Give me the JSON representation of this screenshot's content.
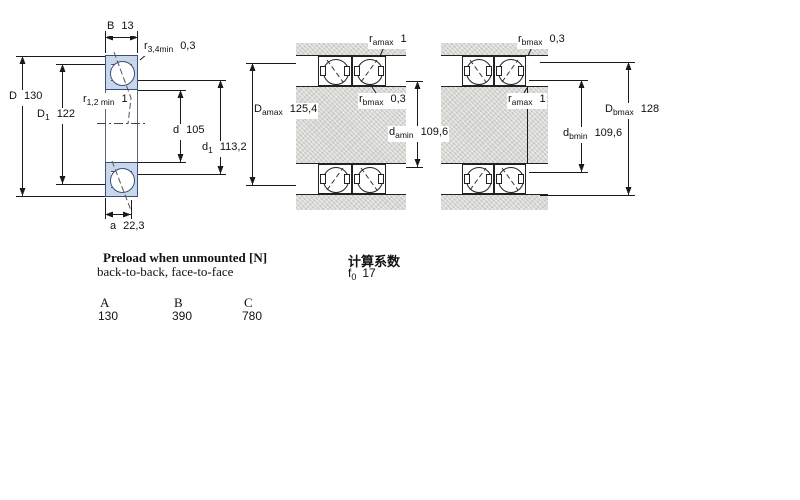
{
  "drawing": {
    "type": "bearing-dimension-drawing",
    "views": [
      "single-bearing-cross-section",
      "paired-mounting-a",
      "paired-mounting-b"
    ]
  },
  "colors": {
    "bearing_fill": "#c9d7ea",
    "bearing_outline": "#3d4e7c",
    "housing_grey": "#d7d7d3",
    "line": "#1a1a1a"
  },
  "dims": {
    "B": {
      "sym": "B",
      "sub": "",
      "value": "13"
    },
    "r34": {
      "sym": "r",
      "sub": "3,4min",
      "value": "0,3"
    },
    "D": {
      "sym": "D",
      "sub": "",
      "value": "130"
    },
    "D1": {
      "sym": "D",
      "sub": "1",
      "value": "122"
    },
    "r12": {
      "sym": "r",
      "sub": "1,2 min",
      "value": "1"
    },
    "d": {
      "sym": "d",
      "sub": "",
      "value": "105"
    },
    "d1": {
      "sym": "d",
      "sub": "1",
      "value": "113,2"
    },
    "a": {
      "sym": "a",
      "sub": "",
      "value": "22,3"
    },
    "ramax_a": {
      "sym": "r",
      "sub": "amax",
      "value": "1"
    },
    "Damax": {
      "sym": "D",
      "sub": "amax",
      "value": "125,4"
    },
    "rbmax_a": {
      "sym": "r",
      "sub": "bmax",
      "value": "0,3"
    },
    "damin": {
      "sym": "d",
      "sub": "amin",
      "value": "109,6"
    },
    "rbmax_b": {
      "sym": "r",
      "sub": "bmax",
      "value": "0,3"
    },
    "ramax_b": {
      "sym": "r",
      "sub": "amax",
      "value": "1"
    },
    "Dbmax": {
      "sym": "D",
      "sub": "bmax",
      "value": "128"
    },
    "dbmin": {
      "sym": "d",
      "sub": "bmin",
      "value": "109,6"
    }
  },
  "preload": {
    "title": "Preload when unmounted [N]",
    "subtitle": "back-to-back, face-to-face",
    "columns": [
      "A",
      "B",
      "C"
    ],
    "values": [
      "130",
      "390",
      "780"
    ]
  },
  "calc": {
    "title": "计算系数",
    "factor_sym": "f",
    "factor_sub": "0",
    "factor_value": "17"
  }
}
